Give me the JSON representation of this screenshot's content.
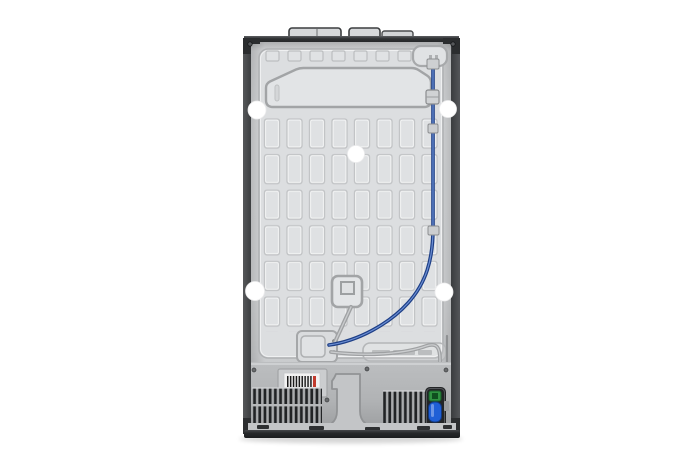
{
  "colors": {
    "background": "#ffffff",
    "panel_gray": "#d8dadc",
    "frame_dark": "#2b2d2f",
    "water_tube_blue": "#1e3f86",
    "tube_gray": "#9fa1a3",
    "valve_green": "#2f9240",
    "valve_body_blue": "#1f5fd6",
    "barcode_red": "#c23b2e",
    "grille_slat": "#212325"
  }
}
